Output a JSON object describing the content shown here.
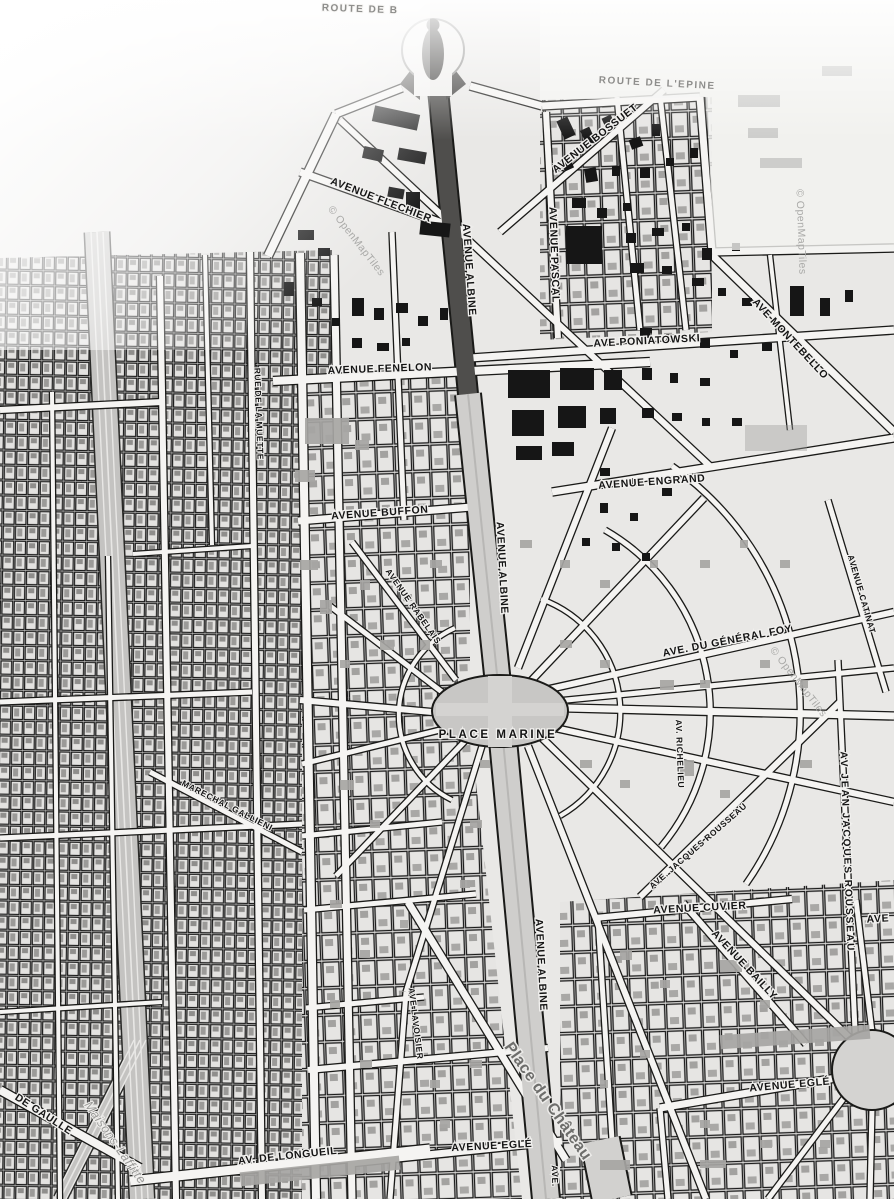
{
  "attribution": "© OpenMapTiles",
  "labels": [
    {
      "name": "route-top-fragment",
      "text": "ROUTE DE B"
    },
    {
      "name": "route-de-lepine",
      "text": "ROUTE DE L'EPINE"
    },
    {
      "name": "avenue-flechier",
      "text": "AVENUE FLECHIER"
    },
    {
      "name": "avenue-bossuet",
      "text": "AVENUE BOSSUET"
    },
    {
      "name": "avenue-pascal",
      "text": "AVENUE PASCAL"
    },
    {
      "name": "avenue-albine-north",
      "text": "AVENUE ALBINE"
    },
    {
      "name": "ave-poniatowski",
      "text": "AVE PONIATOWSKI"
    },
    {
      "name": "ave-montebello",
      "text": "AVE MONTEBELLO"
    },
    {
      "name": "avenue-fenelon",
      "text": "AVENUE FENELON"
    },
    {
      "name": "avenue-buffon",
      "text": "AVENUE BUFFON"
    },
    {
      "name": "avenue-engrand",
      "text": "AVENUE ENGRAND"
    },
    {
      "name": "avenue-albine-mid",
      "text": "AVENUE ALBINE"
    },
    {
      "name": "avenue-rabelais",
      "text": "AVENUE RABELAIS"
    },
    {
      "name": "avenue-catinat",
      "text": "AVENUE CATINAT"
    },
    {
      "name": "ave-du-general-foy",
      "text": "AVE. DU GÉNÉRAL FOY"
    },
    {
      "name": "av-richelieu",
      "text": "AV. RICHELIEU"
    },
    {
      "name": "place-marine",
      "text": "PLACE MARINE"
    },
    {
      "name": "ave-jacques-rousseau",
      "text": "AVE. JACQUES ROUSSEAU"
    },
    {
      "name": "av-jean-jacques-rousseau",
      "text": "AV JEAN JACQUES ROUSSEAU"
    },
    {
      "name": "avenue-cuvier",
      "text": "AVENUE CUVIER"
    },
    {
      "name": "avenue-bailly",
      "text": "AVENUE BAILLY"
    },
    {
      "name": "avenue-egle-east",
      "text": "AVENUE EGLÉ"
    },
    {
      "name": "avenue-egle-center",
      "text": "AVENUE EGLÉ"
    },
    {
      "name": "ave-fragment-bottom",
      "text": "AVE."
    },
    {
      "name": "place-du-chateau",
      "text": "Place du Château"
    },
    {
      "name": "av-de-longueil",
      "text": "AV. DE LONGUEIL"
    },
    {
      "name": "de-gaulle",
      "text": "DE GAULLE"
    },
    {
      "name": "maisons-laffitte",
      "text": "Maisons-Laffitte"
    },
    {
      "name": "rue-de-la-muette",
      "text": "RUE DE LA MUETTE"
    },
    {
      "name": "marechal-gallieni",
      "text": "MARECHAL GALLIENI"
    },
    {
      "name": "ave-lavoisier",
      "text": "AVE LAVOISIER"
    },
    {
      "name": "avenue-albine-south",
      "text": "AVENUE ALBINE"
    },
    {
      "name": "ave-fragment-right",
      "text": "AVE"
    }
  ]
}
